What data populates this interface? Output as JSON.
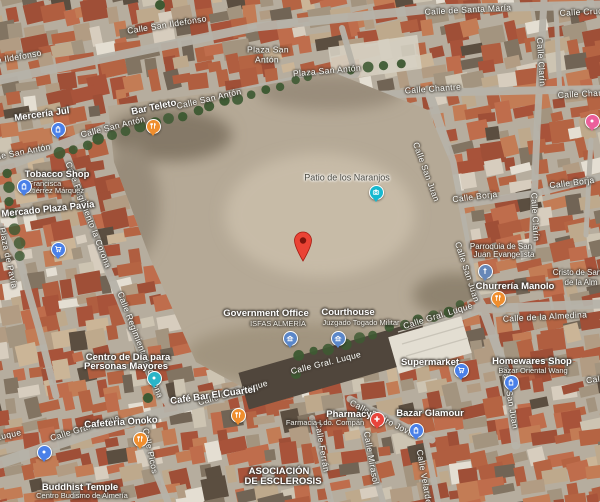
{
  "map": {
    "description": "Satellite map view, Almería old town around blurred military block",
    "marker": {
      "x": 303,
      "y": 241,
      "color": "#ea4335",
      "dot_color": "#7e150d"
    },
    "street_labels": [
      {
        "t": "Calle San Ildefonso",
        "x": 167,
        "y": 25,
        "r": -9
      },
      {
        "t": "Calle San Ildefonso",
        "x": 2,
        "y": 60,
        "r": -10
      },
      {
        "t": "Calle de Santa María",
        "x": 468,
        "y": 10,
        "r": -3
      },
      {
        "t": "Calle Cruces",
        "x": 586,
        "y": 12,
        "r": -3
      },
      {
        "t": "Plaza San",
        "x": 268,
        "y": 50,
        "r": 0
      },
      {
        "t": "Antón",
        "x": 267,
        "y": 60,
        "r": 0
      },
      {
        "t": "Plaza San Antón",
        "x": 327,
        "y": 71,
        "r": -5
      },
      {
        "t": "Calle San Antón",
        "x": 209,
        "y": 99,
        "r": -13
      },
      {
        "t": "Calle San Antón",
        "x": 113,
        "y": 127,
        "r": -14
      },
      {
        "t": "Calle San Antón",
        "x": 18,
        "y": 153,
        "r": -11
      },
      {
        "t": "Calle Chantre",
        "x": 433,
        "y": 89,
        "r": -4
      },
      {
        "t": "Calle Chantre",
        "x": 586,
        "y": 94,
        "r": -3
      },
      {
        "t": "Calle Clarín",
        "x": 541,
        "y": 62,
        "r": 86
      },
      {
        "t": "Calle Clarín",
        "x": 535,
        "y": 217,
        "r": 87
      },
      {
        "t": "Calle Borja",
        "x": 475,
        "y": 197,
        "r": -7
      },
      {
        "t": "Calle Borja",
        "x": 572,
        "y": 183,
        "r": -7
      },
      {
        "t": "Calle San Juan",
        "x": 426,
        "y": 172,
        "r": 70
      },
      {
        "t": "Calle San Juan",
        "x": 467,
        "y": 272,
        "r": 72
      },
      {
        "t": "Calle San Juan",
        "x": 510,
        "y": 398,
        "r": 80
      },
      {
        "t": "Calle Regimiento la Corona",
        "x": 88,
        "y": 215,
        "r": 69
      },
      {
        "t": "Calle Regimiento la Corona",
        "x": 140,
        "y": 345,
        "r": 69
      },
      {
        "t": "Plaza de Pavía",
        "x": 8,
        "y": 258,
        "r": 78
      },
      {
        "t": "Calle Gral. Luque",
        "x": 438,
        "y": 316,
        "r": -17
      },
      {
        "t": "Calle Gral. Luque",
        "x": 326,
        "y": 363,
        "r": -14
      },
      {
        "t": "Calle Gral. Luque",
        "x": 233,
        "y": 393,
        "r": -16
      },
      {
        "t": "Calle Gral. Luque",
        "x": 85,
        "y": 428,
        "r": -17
      },
      {
        "t": "Calle Gral. Luque",
        "x": -14,
        "y": 440,
        "r": -12
      },
      {
        "t": "Calle de la Almedina",
        "x": 545,
        "y": 317,
        "r": -3
      },
      {
        "t": "Calle de la Almedina",
        "x": 628,
        "y": 375,
        "r": -8
      },
      {
        "t": "Calle Picos",
        "x": 150,
        "y": 451,
        "r": 78
      },
      {
        "t": "Calle Pedro Jover",
        "x": 383,
        "y": 419,
        "r": 27
      },
      {
        "t": "Calle Ferrán",
        "x": 322,
        "y": 447,
        "r": 80
      },
      {
        "t": "Calle Mirasol",
        "x": 371,
        "y": 458,
        "r": 80
      },
      {
        "t": "Calle Velarde",
        "x": 424,
        "y": 477,
        "r": 80
      }
    ],
    "poi_labels": [
      {
        "t": "Mercería Jul",
        "x": 42,
        "y": 115,
        "r": -8,
        "k": "bold"
      },
      {
        "t": "Bar Teleto",
        "x": 154,
        "y": 108,
        "r": -12,
        "k": "bold"
      },
      {
        "t": "Tobacco Shop",
        "x": 57,
        "y": 175,
        "r": 0,
        "k": "bold"
      },
      {
        "t": "Francisca",
        "x": 45,
        "y": 184,
        "r": 0,
        "k": "sub"
      },
      {
        "t": "Gutiérrez Márquez",
        "x": 53,
        "y": 191,
        "r": 0,
        "k": "sub"
      },
      {
        "t": "Mercado Plaza Pavía",
        "x": 48,
        "y": 210,
        "r": -6,
        "k": "bold"
      },
      {
        "t": "Patio de los Naranjos",
        "x": 347,
        "y": 178,
        "r": 0,
        "k": "attr"
      },
      {
        "t": "Government Office",
        "x": 266,
        "y": 314,
        "r": 0,
        "k": "bold"
      },
      {
        "t": "ISFAS ALMERÍA",
        "x": 278,
        "y": 324,
        "r": 0,
        "k": "sub"
      },
      {
        "t": "Courthouse",
        "x": 348,
        "y": 313,
        "r": 0,
        "k": "bold"
      },
      {
        "t": "Juzgado Togado Militar",
        "x": 361,
        "y": 323,
        "r": 0,
        "k": "sub"
      },
      {
        "t": "Supermarket",
        "x": 430,
        "y": 363,
        "r": 0,
        "k": "bold"
      },
      {
        "t": "Homewares Shop",
        "x": 532,
        "y": 362,
        "r": 0,
        "k": "bold"
      },
      {
        "t": "Bazar Oriental Wang",
        "x": 533,
        "y": 371,
        "r": 0,
        "k": "sub"
      },
      {
        "t": "Parroquia de San",
        "x": 501,
        "y": 247,
        "r": 0,
        "k": "sub2"
      },
      {
        "t": "Juan Evangelista",
        "x": 504,
        "y": 255,
        "r": 0,
        "k": "sub2"
      },
      {
        "t": "Churrería Manolo",
        "x": 515,
        "y": 287,
        "r": 0,
        "k": "bold"
      },
      {
        "t": "Cristo de San",
        "x": 577,
        "y": 273,
        "r": 0,
        "k": "sub2"
      },
      {
        "t": "de la Alm",
        "x": 581,
        "y": 283,
        "r": 0,
        "k": "sub2"
      },
      {
        "t": "Centro de Día para",
        "x": 128,
        "y": 358,
        "r": 0,
        "k": "bold"
      },
      {
        "t": "Personas Mayores",
        "x": 126,
        "y": 367,
        "r": 0,
        "k": "bold"
      },
      {
        "t": "Café Bar El Cuartel",
        "x": 213,
        "y": 396,
        "r": -8,
        "k": "bold"
      },
      {
        "t": "Cafetería Onoko",
        "x": 121,
        "y": 423,
        "r": -4,
        "k": "bold"
      },
      {
        "t": "Pharmacy",
        "x": 349,
        "y": 415,
        "r": 0,
        "k": "bold"
      },
      {
        "t": "Farmacia Ldo. Compán",
        "x": 325,
        "y": 423,
        "r": 0,
        "k": "sub"
      },
      {
        "t": "Bazar Glamour",
        "x": 430,
        "y": 414,
        "r": 0,
        "k": "bold"
      },
      {
        "t": "ASOCIACIÓN",
        "x": 279,
        "y": 472,
        "r": 0,
        "k": "bold"
      },
      {
        "t": "DE ESCLEROSIS",
        "x": 283,
        "y": 482,
        "r": 0,
        "k": "bold"
      },
      {
        "t": "Buddhist Temple",
        "x": 80,
        "y": 488,
        "r": 0,
        "k": "bold"
      },
      {
        "t": "Centro Budismo de Almería",
        "x": 82,
        "y": 496,
        "r": 0,
        "k": "sub"
      }
    ],
    "pins": [
      {
        "kind": "shop",
        "x": 57,
        "y": 128,
        "c": "#4a80e8"
      },
      {
        "kind": "food",
        "x": 152,
        "y": 125,
        "c": "#ef8e2e"
      },
      {
        "kind": "shop",
        "x": 23,
        "y": 185,
        "c": "#4a80e8"
      },
      {
        "kind": "cart",
        "x": 57,
        "y": 248,
        "c": "#4a80e8"
      },
      {
        "kind": "camera",
        "x": 375,
        "y": 191,
        "c": "#15b8cf"
      },
      {
        "kind": "gov",
        "x": 289,
        "y": 337,
        "c": "#5b87c9"
      },
      {
        "kind": "gov",
        "x": 337,
        "y": 337,
        "c": "#5b87c9"
      },
      {
        "kind": "cart",
        "x": 460,
        "y": 369,
        "c": "#4a80e8"
      },
      {
        "kind": "shop",
        "x": 510,
        "y": 381,
        "c": "#4a80e8"
      },
      {
        "kind": "church",
        "x": 484,
        "y": 270,
        "c": "#6787b7"
      },
      {
        "kind": "food",
        "x": 497,
        "y": 297,
        "c": "#ef8e2e"
      },
      {
        "kind": "dot",
        "x": 153,
        "y": 377,
        "c": "#2ab5c8"
      },
      {
        "kind": "food",
        "x": 237,
        "y": 414,
        "c": "#ef8e2e"
      },
      {
        "kind": "food",
        "x": 139,
        "y": 438,
        "c": "#ef8e2e"
      },
      {
        "kind": "pharmacy",
        "x": 376,
        "y": 418,
        "c": "#e8453c"
      },
      {
        "kind": "shop",
        "x": 415,
        "y": 429,
        "c": "#4a80e8"
      },
      {
        "kind": "dot",
        "x": 43,
        "y": 451,
        "c": "#4a80e8"
      },
      {
        "kind": "dot",
        "x": 591,
        "y": 120,
        "c": "#ec5f9b"
      }
    ],
    "colors": {
      "ground": "#b6ad9e",
      "road": "#b7b3a9",
      "blurred_area": "#b5a996",
      "tree": "#3e5a33"
    }
  }
}
